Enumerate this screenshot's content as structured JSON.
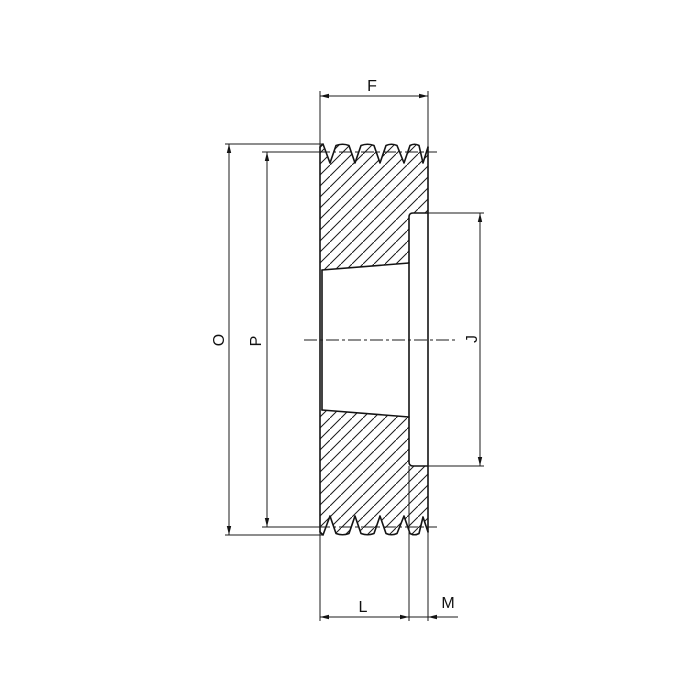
{
  "drawing": {
    "background": "#ffffff",
    "line_color": "#141414",
    "labels": {
      "F": "F",
      "O": "O",
      "P": "P",
      "J": "J",
      "L": "L",
      "M": "M"
    }
  }
}
